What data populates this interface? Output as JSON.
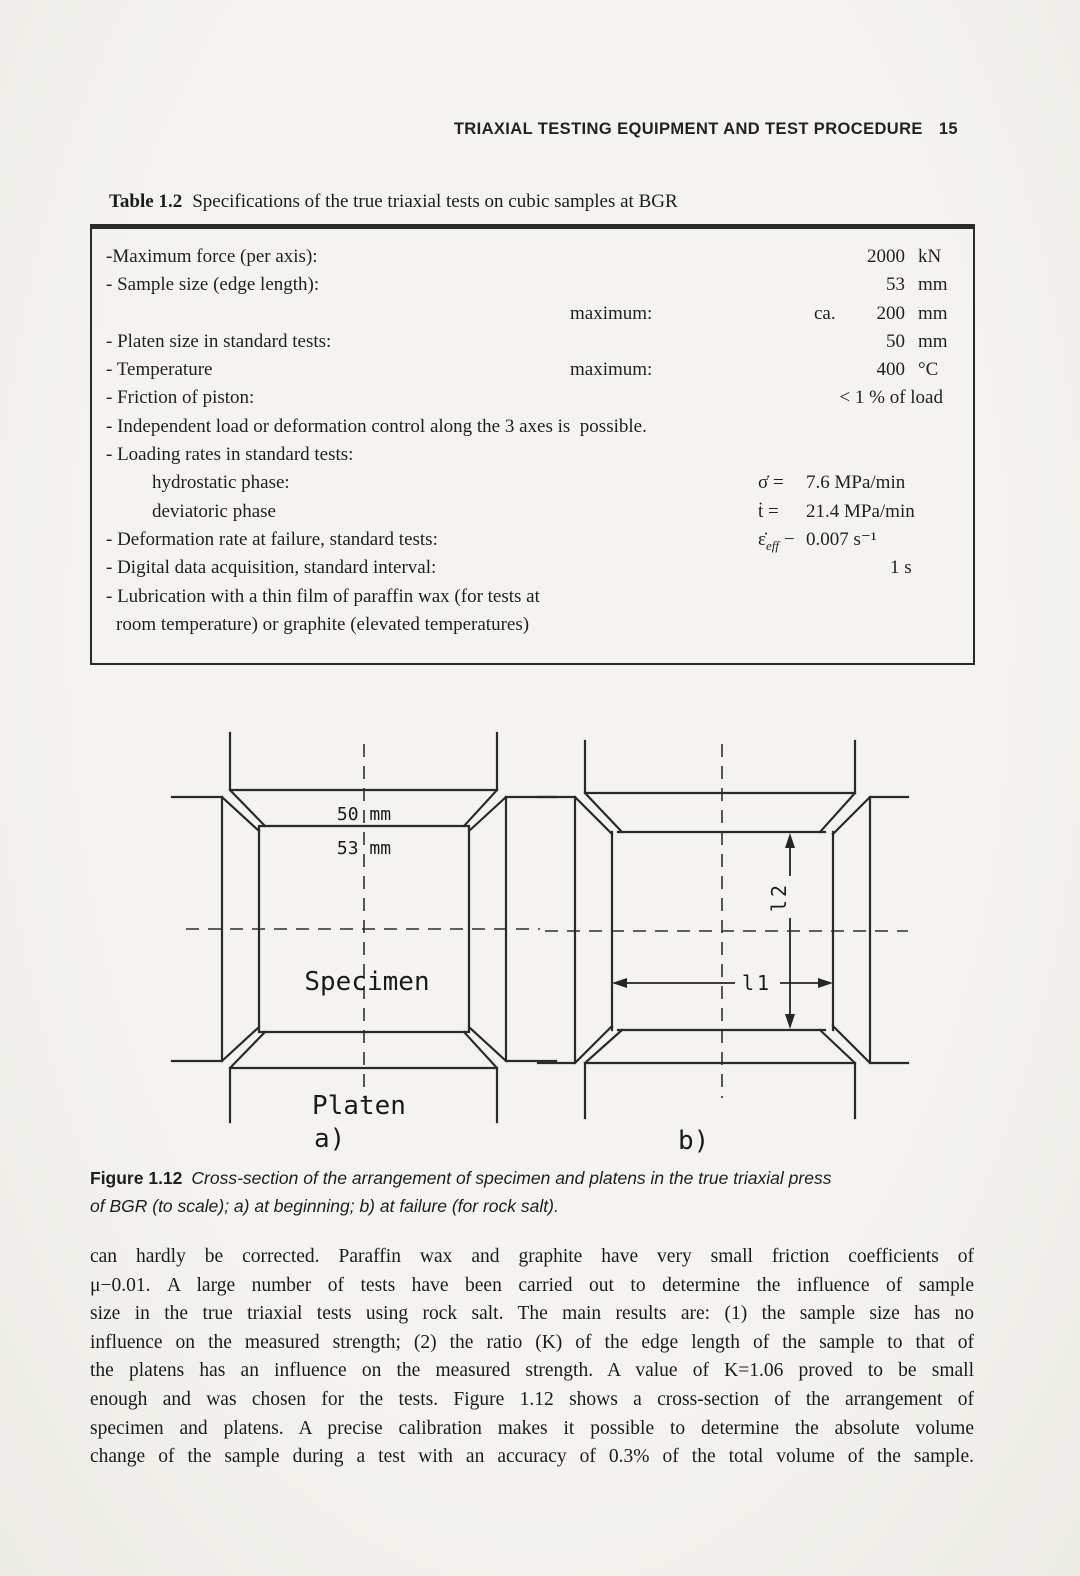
{
  "colors": {
    "paper": "#f1f0ec",
    "ink": "#1f1f1f"
  },
  "header": {
    "title": "TRIAXIAL TESTING EQUIPMENT AND TEST PROCEDURE",
    "page_number": "15"
  },
  "table_caption": {
    "label": "Table 1.2",
    "text": "Specifications of the true triaxial tests on cubic samples at BGR"
  },
  "spec_table": {
    "rows": [
      {
        "label": "-Maximum force (per axis):",
        "num": "2000",
        "unit": "kN"
      },
      {
        "label": "- Sample size (edge length):",
        "num": "53",
        "unit": "mm"
      },
      {
        "label": "",
        "mid": "maximum:",
        "ca": "ca.",
        "num": "200",
        "unit": "mm"
      },
      {
        "label": "- Platen size in standard tests:",
        "num": "50",
        "unit": "mm"
      },
      {
        "label": "- Temperature",
        "mid": "maximum:",
        "num": "400",
        "unit": "°C"
      },
      {
        "label": "- Friction of piston:",
        "rval": "< 1 % of load"
      },
      {
        "label": "- Independent load or deformation control along the 3 axes is  possible."
      },
      {
        "label": "- Loading rates in standard tests:"
      },
      {
        "label": "hydrostatic phase:",
        "sym": "σ̇ =",
        "sval": "7.6 MPa/min"
      },
      {
        "label": "deviatoric phase",
        "sym": "ṫ =",
        "sval": "21.4 MPa/min"
      },
      {
        "label": "- Deformation rate at failure, standard tests:",
        "sym_main": "ε̇",
        "sym_sub": "eff",
        "sym_eq": "−",
        "sval": "0.007 s⁻¹"
      },
      {
        "label": "- Digital data acquisition, standard interval:",
        "cval": "1 s"
      },
      {
        "label": "- Lubrication with a thin film of paraffin wax (for tests at"
      },
      {
        "label": "room temperature) or graphite (elevated temperatures)"
      }
    ]
  },
  "figure": {
    "a": {
      "platen_width": "50 mm",
      "specimen_width": "53 mm",
      "specimen_label": "Specimen",
      "platen_label": "Platen",
      "sublabel": "a)"
    },
    "b": {
      "sublabel": "b)",
      "dim_h": "l1",
      "dim_v": "l2"
    }
  },
  "figure_caption": {
    "label": "Figure 1.12",
    "line1": "Cross-section of the arrangement of specimen and platens in the true triaxial press",
    "line2": "of BGR (to scale); a) at beginning; b) at failure (for rock salt)."
  },
  "body": {
    "lines": [
      "can hardly be corrected. Paraffin wax and graphite have very small friction coefficients of",
      "μ−0.01. A large number of tests have been carried out to determine the influence of sample",
      "size in the true triaxial tests using rock salt. The main results are: (1) the sample size has no",
      "influence on the measured strength; (2) the ratio (K) of the edge length of the sample to that of",
      "the platens has an influence on the measured strength. A value of K=1.06 proved to be small",
      "enough and was chosen for the tests. Figure 1.12 shows a cross-section of the arrangement of",
      "specimen and platens. A precise calibration makes it possible  to determine the absolute volume",
      "change of the sample during a test with an accuracy of 0.3%  of the total volume of the sample."
    ]
  }
}
